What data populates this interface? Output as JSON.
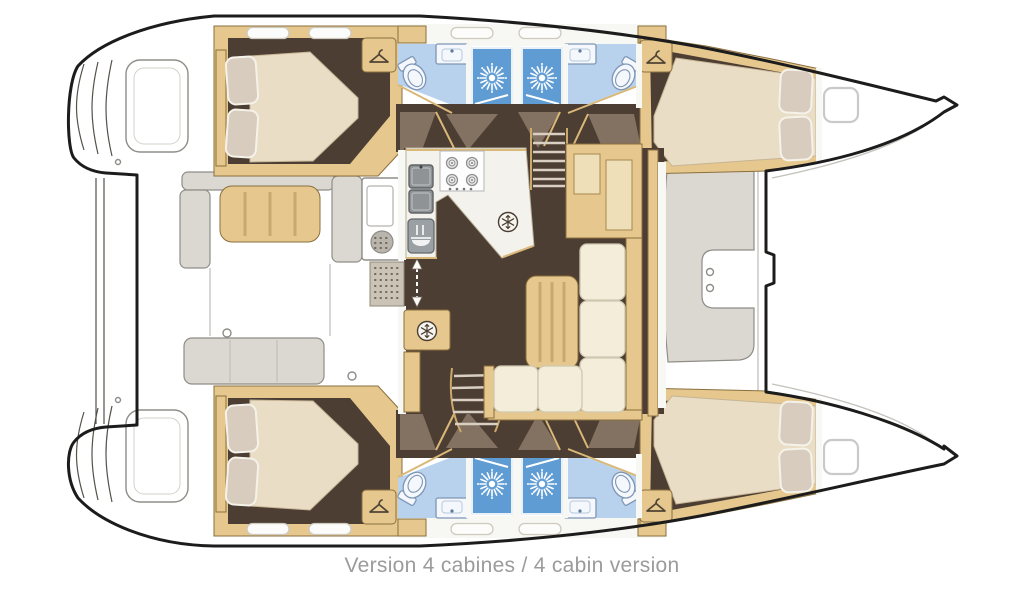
{
  "caption": "Version 4 cabines / 4 cabin version",
  "colors": {
    "outline": "#1c1c1c",
    "line_gray": "#8f8d88",
    "furn_gray": "#dbd8d2",
    "wood": "#e6c88e",
    "wood_edge": "#8a6f3e",
    "floor": "#4d3e34",
    "swing": "#8d7b6b",
    "counter": "#f4f2ec",
    "bath": "#b8d2ee",
    "shower": "#5f9cd3",
    "fixw": "#f4f7fb",
    "fixe": "#7e96b5",
    "mattress": "#e9ddc6",
    "pillow": "#d7ccbd",
    "cushion": "#f3edda",
    "cushion_edge": "#cfc8b0",
    "trim": "#d9b878",
    "mat": "#cbc4b6",
    "stainless": "#8f9396",
    "caption_color": "#9b9b9b"
  },
  "icons": [
    {
      "name": "sun-icon",
      "represents": "shower stall"
    },
    {
      "name": "snowflake-icon",
      "represents": "refrigerator / freezer"
    },
    {
      "name": "hanger-icon",
      "represents": "hanging wardrobe"
    },
    {
      "name": "burner-icon",
      "represents": "stove burner"
    },
    {
      "name": "fork-dish-icon",
      "represents": "oven"
    },
    {
      "name": "double-arrow-icon",
      "represents": "companionway passage"
    }
  ]
}
